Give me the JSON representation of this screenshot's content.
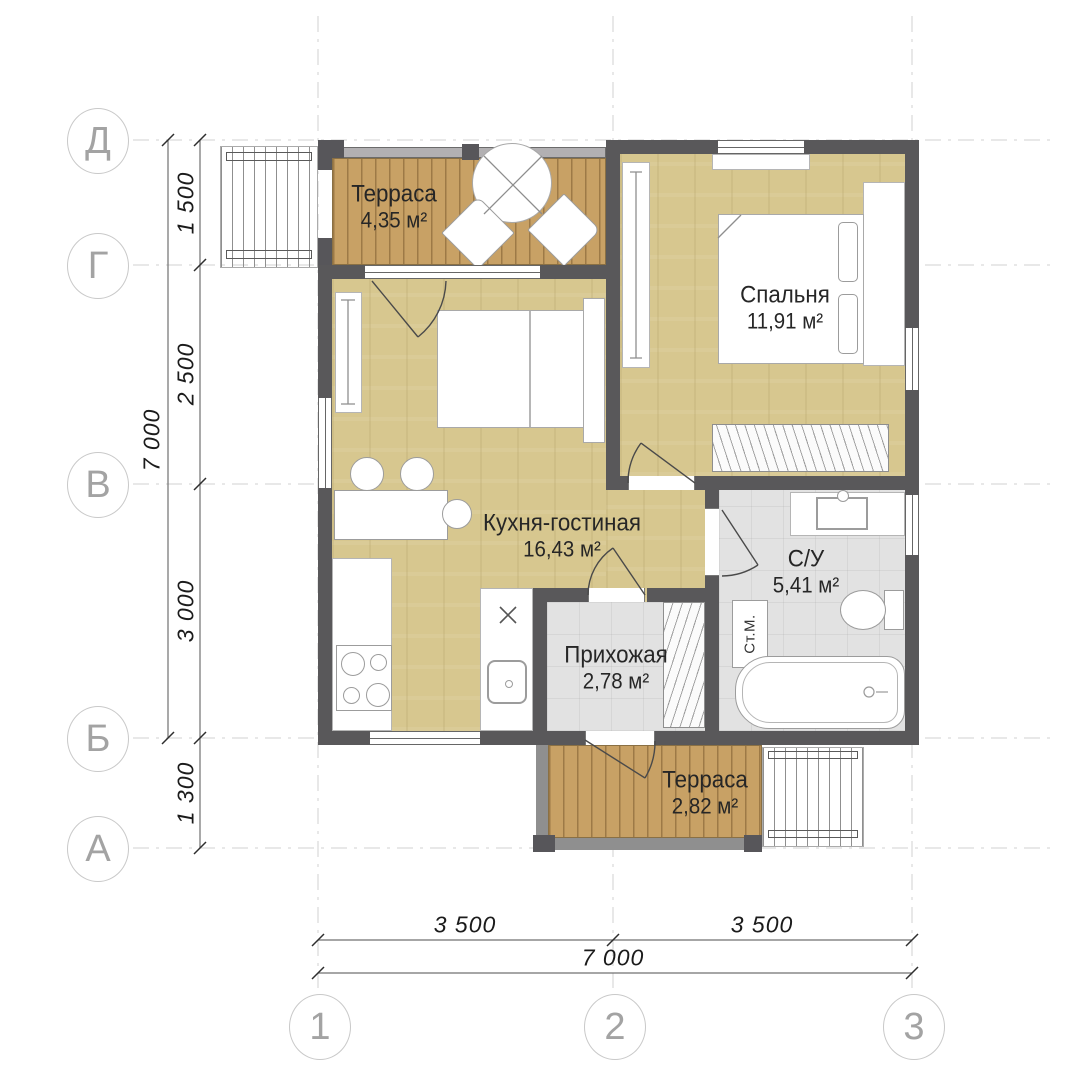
{
  "rooms": [
    {
      "name": "Терраса",
      "area": "4,35 м²"
    },
    {
      "name": "Спальня",
      "area": "11,91 м²"
    },
    {
      "name": "Кухня-гостиная",
      "area": "16,43 м²"
    },
    {
      "name": "С/У",
      "area": "5,41 м²"
    },
    {
      "name": "Прихожая",
      "area": "2,78 м²"
    },
    {
      "name": "Терраса",
      "area": "2,82 м²"
    }
  ],
  "appliance_labels": {
    "washing_machine": "Ст.М."
  },
  "grid_axes": {
    "rows": [
      "Д",
      "Г",
      "В",
      "Б",
      "А"
    ],
    "columns": [
      "1",
      "2",
      "3"
    ]
  },
  "dimensions": {
    "left": {
      "segments": [
        "1 500",
        "2 500",
        "3 000",
        "1 300"
      ],
      "total": "7 000"
    },
    "bottom": {
      "segments": [
        "3 500",
        "3 500"
      ],
      "total": "7 000"
    }
  },
  "colors": {
    "wall": "#59585a",
    "wood_floor": "#d7c78f",
    "terrace_deck": "#c8a165",
    "tile_floor": "#e2e2e2",
    "dimension_line": "#707070",
    "grid_line": "#d2d2d2",
    "label_text": "#262626"
  }
}
